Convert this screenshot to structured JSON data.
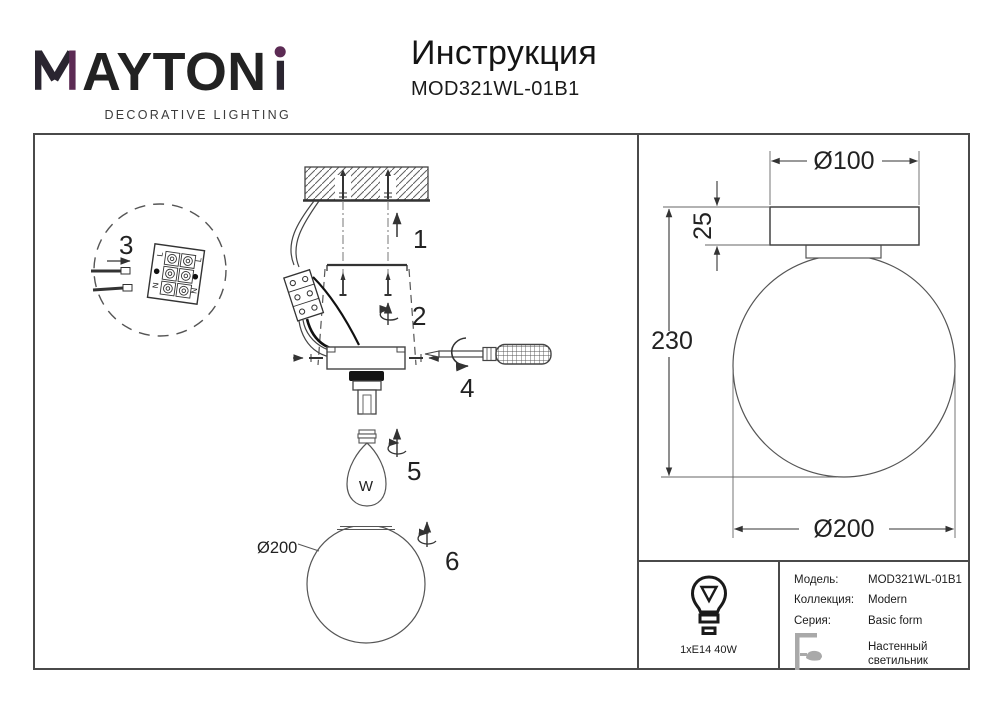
{
  "brand": {
    "name": "MAYTONI",
    "word_center": "AYTON",
    "tagline": "DECORATIVE LIGHTING",
    "accent_color": "#5c2b54",
    "text_color": "#2a2530"
  },
  "header": {
    "title": "Инструкция",
    "model": "MOD321WL-01B1"
  },
  "steps": [
    "1",
    "2",
    "3",
    "4",
    "5",
    "6"
  ],
  "drawing_labels": {
    "globe_diameter": "Ø200",
    "bulb_marking": "W",
    "terminal_live": "L",
    "terminal_neutral": "N"
  },
  "dimensions": {
    "canopy_diameter": "Ø100",
    "canopy_height": "25",
    "total_height": "230",
    "globe_diameter": "Ø200"
  },
  "spec": {
    "lamp": "1xE14 40W",
    "rows": [
      {
        "label": "Модель:",
        "value": "MOD321WL-01B1"
      },
      {
        "label": "Коллекция:",
        "value": "Modern"
      },
      {
        "label": "Серия:",
        "value": "Basic form"
      },
      {
        "label": "",
        "value": "Настенный светильник"
      }
    ]
  }
}
